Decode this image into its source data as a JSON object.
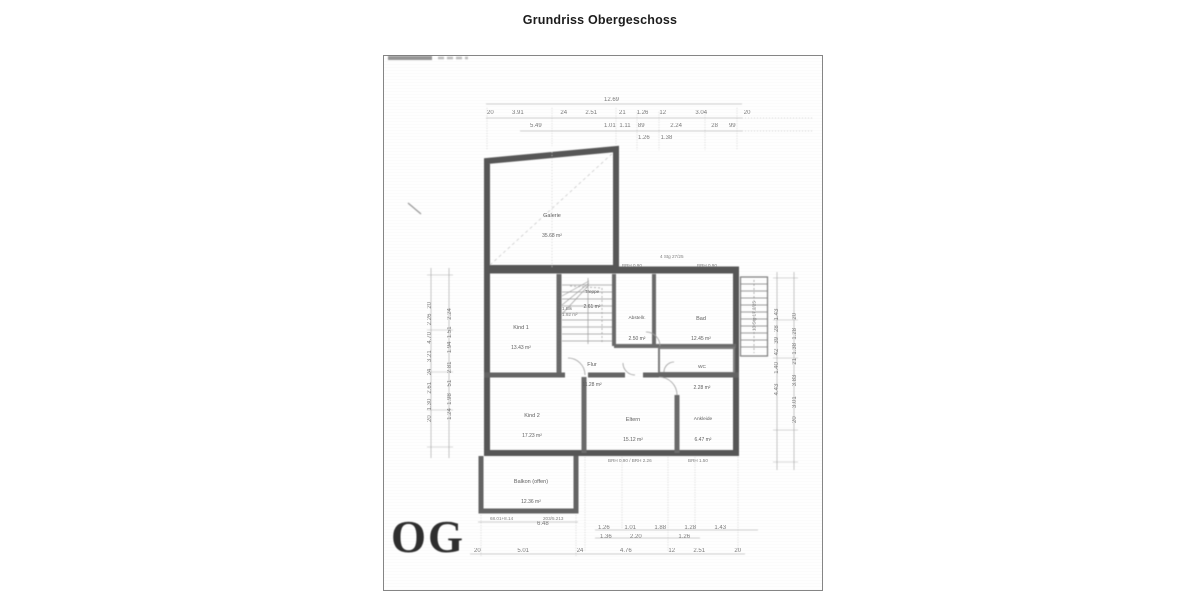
{
  "header": {
    "title": "Grundriss Obergeschoss"
  },
  "plan": {
    "floor_label": "OG",
    "rooms": [
      {
        "name": "Galerie",
        "area": "35.68 m²"
      },
      {
        "name": "Kind 1",
        "area": "13.43 m²"
      },
      {
        "name": "Treppe",
        "area": "2.61 m²"
      },
      {
        "name": "Abstellr.",
        "area": "2.50 m²"
      },
      {
        "name": "Bad",
        "area": "12.45 m²"
      },
      {
        "name": "Flur",
        "area": "11.28 m²"
      },
      {
        "name": "WC",
        "area": "2.28 m²"
      },
      {
        "name": "Kind 2",
        "area": "17.23 m²"
      },
      {
        "name": "Eltern",
        "area": "15.12 m²"
      },
      {
        "name": "Ankleide",
        "area": "6.47 m²"
      },
      {
        "name": "Balkon (offen)",
        "area": "12.36 m²"
      }
    ],
    "dims": {
      "top_total": "12.69",
      "top_row_parts": "20     3.91          24     2.51      21   1.26   12        3.04          20",
      "top_row_sub": "5.49                 1.01 1.11  89       2.24        28   99",
      "top_row_sub2": "1.26   1.38",
      "bottom_balcony": "6.48",
      "bottom_row_a": "1.26    1.01     1.88     1.28     1.43",
      "bottom_row_b": "1.36     2.20          1.26",
      "bottom_total_row": "20          5.01             24          4.76          12     2.51        20",
      "left_outer": "20   1.30   2.61    24    3.21    4.70    2.26   20",
      "left_inner": "1.24  1.98    51    2.81     1.94  1.51    2.24",
      "right_inner": "4.43      1.40    42   39   28   1.43",
      "right_outer": "20     3.01      3.83      21  1.38  1.28     20"
    },
    "annotations": [
      {
        "text": "BRH 0.90"
      },
      {
        "text": "4 Stg 27/25"
      },
      {
        "text": "BRH 0.90"
      },
      {
        "text": "1.Blk"
      },
      {
        "text": "1.92 m²"
      },
      {
        "text": "BRH 0.90 / BRH 2.26"
      },
      {
        "text": "BRH 1.50"
      },
      {
        "text": "68.01+8.14"
      },
      {
        "text": "203/5.213"
      },
      {
        "text": "13 Stg 17.2/25"
      }
    ]
  }
}
